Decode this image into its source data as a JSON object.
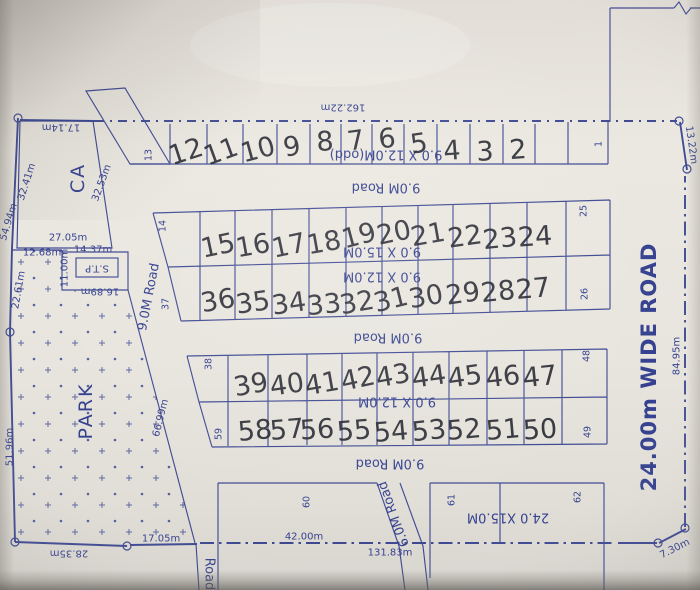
{
  "areas": {
    "ca": "CA",
    "park": "PARK",
    "stp": "S.T.P"
  },
  "roads": {
    "v9": "9.0M Road",
    "t9": "9.0M Road",
    "m9": "9.0M Road",
    "b9": "9.0M Road",
    "r6": "6.0M Road",
    "wide": "24.00m WIDE ROAD",
    "partial": "Road"
  },
  "sizes": {
    "row1": "9.0 X 12.0M(odd)",
    "row2a": "9.0 X 15.0M",
    "row2b": "9.0 X 12.0M",
    "row3": "9.0 X 12.0M",
    "row4": "24.0 X15.0M"
  },
  "dims": {
    "t162": "162.22m",
    "t17": "17.14m",
    "tr13": "13.22m",
    "r84": "84.95m",
    "br7": "7.30m",
    "b131": "131.83m",
    "b42": "42.00m",
    "b17": "17.05m",
    "b28": "28.35m",
    "l51": "51.96m",
    "l22": "22.61m",
    "l66": "66.99m",
    "l54": "54.94m",
    "l32": "32.41m",
    "ca27": "27.05m",
    "ca32": "32.53m",
    "s12": "12.68m",
    "s14": "14.37m",
    "s11": "11.00m",
    "s16": "16.89m"
  },
  "plots": {
    "printed": {
      "p13": "13",
      "p1": "1",
      "p14": "14",
      "p25": "25",
      "p37": "37",
      "p26": "26",
      "p38": "38",
      "p48": "48",
      "p59": "59",
      "p49": "49",
      "p60": "60",
      "p61": "61",
      "p62": "62"
    },
    "row1": [
      "12",
      "11",
      "10",
      "9",
      "8",
      "7",
      "6",
      "5",
      "4",
      "3",
      "2"
    ],
    "row2_top": [
      "15",
      "16",
      "17",
      "18",
      "19",
      "20",
      "21",
      "22",
      "23",
      "24"
    ],
    "row2_bottom": [
      "36",
      "35",
      "34",
      "33",
      "32",
      "31",
      "30",
      "29",
      "28",
      "27"
    ],
    "row3_top": [
      "39",
      "40",
      "41",
      "42",
      "43",
      "44",
      "45",
      "46",
      "47"
    ],
    "row3_bottom": [
      "58",
      "57",
      "56",
      "55",
      "54",
      "53",
      "52",
      "51",
      "50"
    ]
  }
}
